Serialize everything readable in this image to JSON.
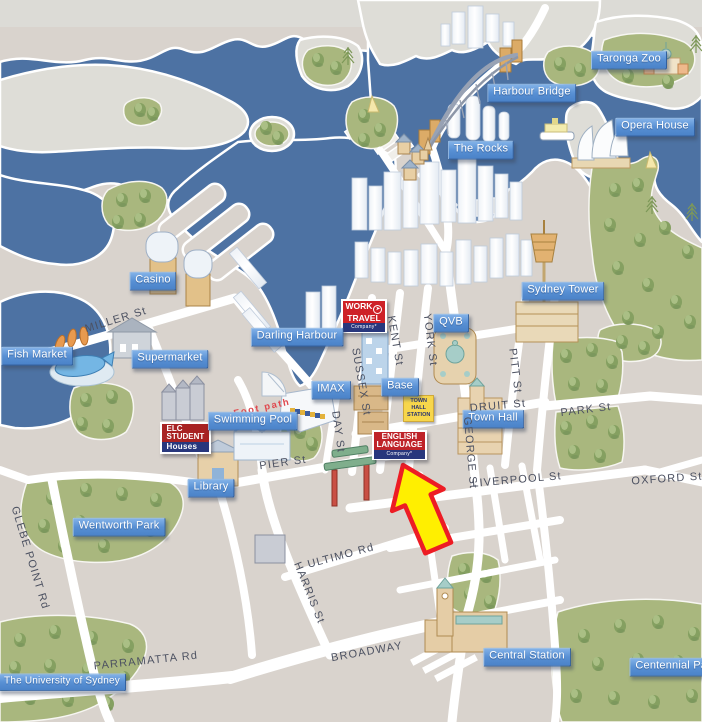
{
  "colors": {
    "water": "#4d72a3",
    "land": "#d9d3cd",
    "pale_land": "#deddd7",
    "park": "#a9b77e",
    "road": "#ffffff",
    "badge_blue": "#5890d4",
    "street_text": "#4c5161",
    "footpath_red": "#e0474d",
    "arrow_fill": "#ffef00",
    "arrow_stroke": "#ed1c24",
    "sign_red": "#ce2127",
    "sign_dark_red": "#a82222",
    "company_blue": "#28377d",
    "station_yellow": "#f7d64b"
  },
  "map": {
    "badges": [
      {
        "id": "taronga-zoo",
        "label": "Taronga Zoo",
        "x": 629,
        "y": 60
      },
      {
        "id": "harbour-bridge",
        "label": "Harbour Bridge",
        "x": 532,
        "y": 93
      },
      {
        "id": "opera-house",
        "label": "Opera House",
        "x": 655,
        "y": 127
      },
      {
        "id": "the-rocks",
        "label": "The Rocks",
        "x": 481,
        "y": 150
      },
      {
        "id": "sydney-tower",
        "label": "Sydney Tower",
        "x": 563,
        "y": 291
      },
      {
        "id": "qvb",
        "label": "QVB",
        "x": 451,
        "y": 323
      },
      {
        "id": "casino",
        "label": "Casino",
        "x": 153,
        "y": 281
      },
      {
        "id": "darling-harbour",
        "label": "Darling Harbour",
        "x": 297,
        "y": 337
      },
      {
        "id": "fish-market",
        "label": "Fish Market",
        "x": 37,
        "y": 356
      },
      {
        "id": "supermarket",
        "label": "Supermarket",
        "x": 170,
        "y": 359
      },
      {
        "id": "imax",
        "label": "IMAX",
        "x": 331,
        "y": 390
      },
      {
        "id": "base",
        "label": "Base",
        "x": 400,
        "y": 387
      },
      {
        "id": "town-hall",
        "label": "Town Hall",
        "x": 493,
        "y": 419
      },
      {
        "id": "swimming-pool",
        "label": "Swimming Pool",
        "x": 253,
        "y": 421
      },
      {
        "id": "library",
        "label": "Library",
        "x": 211,
        "y": 488
      },
      {
        "id": "wentworth-park",
        "label": "Wentworth Park",
        "x": 119,
        "y": 527
      },
      {
        "id": "central-station",
        "label": "Central Station",
        "x": 527,
        "y": 657
      },
      {
        "id": "centennial-park",
        "label": "Centennial Park",
        "x": 676,
        "y": 667
      },
      {
        "id": "university-of-sydney",
        "label": "The University of Sydney",
        "x": 62,
        "y": 682,
        "size": 10
      }
    ],
    "streets": [
      {
        "id": "miller-st",
        "label": "MILLER St",
        "x": 116,
        "y": 320,
        "rot": -17
      },
      {
        "id": "kent-st",
        "label": "KENT St",
        "x": 395,
        "y": 341,
        "rot": 80
      },
      {
        "id": "york-st",
        "label": "YORK St",
        "x": 430,
        "y": 340,
        "rot": 83
      },
      {
        "id": "sussex-st",
        "label": "SUSSEX St",
        "x": 361,
        "y": 382,
        "rot": 80
      },
      {
        "id": "day-st",
        "label": "DAY St",
        "x": 338,
        "y": 432,
        "rot": 82
      },
      {
        "id": "pitt-st",
        "label": "PITT St",
        "x": 515,
        "y": 371,
        "rot": 83
      },
      {
        "id": "george-st",
        "label": "GEORGE St",
        "x": 470,
        "y": 453,
        "rot": 85
      },
      {
        "id": "druitt-st",
        "label": "DRUIT St",
        "x": 498,
        "y": 406,
        "rot": -5
      },
      {
        "id": "park-st",
        "label": "PARK St",
        "x": 586,
        "y": 410,
        "rot": -7
      },
      {
        "id": "liverpool-st",
        "label": "LIVERPOOL St",
        "x": 517,
        "y": 480,
        "rot": -5
      },
      {
        "id": "oxford-st",
        "label": "OXFORD St",
        "x": 667,
        "y": 479,
        "rot": -4
      },
      {
        "id": "pier-st",
        "label": "PIER St",
        "x": 283,
        "y": 463,
        "rot": -8
      },
      {
        "id": "ultimo-rd",
        "label": "ULTIMO Rd",
        "x": 341,
        "y": 556,
        "rot": -15
      },
      {
        "id": "harris-st",
        "label": "HARRIS St",
        "x": 309,
        "y": 593,
        "rot": 68
      },
      {
        "id": "broadway",
        "label": "BROADWAY",
        "x": 367,
        "y": 652,
        "rot": -10
      },
      {
        "id": "parramatta-rd",
        "label": "PARRAMATTA Rd",
        "x": 146,
        "y": 661,
        "rot": -6
      },
      {
        "id": "glebe-point-rd",
        "label": "GLEBE POINT Rd",
        "x": 30,
        "y": 558,
        "rot": 73
      }
    ],
    "signs": {
      "work_travel": {
        "line1": "WORK",
        "line2": "TRAVEL",
        "strip": "Company*"
      },
      "english_language": {
        "line1": "ENGLISH",
        "line2": "LANGUAGE",
        "strip": "Company*"
      },
      "elc_student": {
        "line1": "ELC",
        "line2": "STUDENT",
        "strip": "Houses"
      },
      "town_hall_station": {
        "line1": "TOWN",
        "line2": "HALL",
        "line3": "STATION"
      },
      "foot_path": {
        "label": "Foot path"
      }
    }
  }
}
